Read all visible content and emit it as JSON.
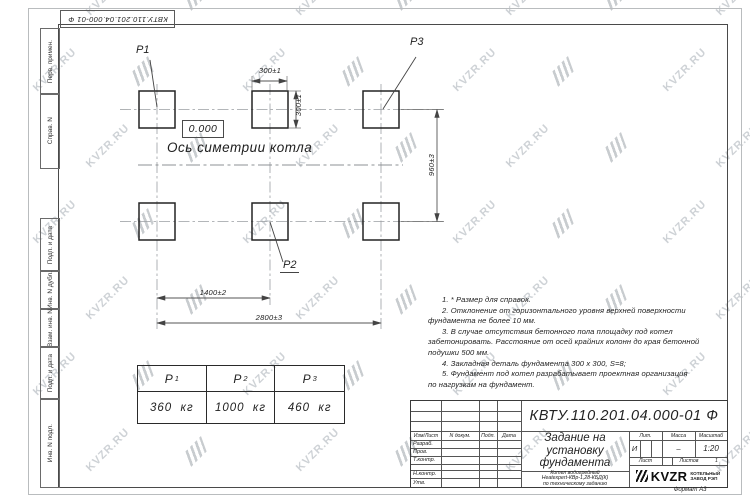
{
  "doc_number": "КВТУ.110.201.04.000-01 Ф",
  "watermark": {
    "text": "KVZR.RU"
  },
  "margin_labels": {
    "perv_primen": "Перв. примен.",
    "sprav_n": "Справ. N",
    "podp_data_1": "Подп. и дата",
    "inv_n_dubl": "Инв. N дубл.",
    "vzam_inv_n": "Взам. инв. N",
    "podp_data_2": "Подп. и дата",
    "inv_n_podl": "Инв. N подл."
  },
  "drawing": {
    "elevation": "0.000",
    "axis_label": "Ось симетрии котла",
    "labels": {
      "p1": "P1",
      "p2": "P2",
      "p3": "P3"
    },
    "dims": {
      "pad_width": "300±1",
      "pad_height": "300±1",
      "row_pitch": "960±3",
      "col_pitch": "1400±2",
      "overall": "2800±3"
    }
  },
  "load_table": {
    "columns": [
      {
        "name": "P",
        "sub": "1",
        "value": "360  кг"
      },
      {
        "name": "P",
        "sub": "2",
        "value": "1000  кг"
      },
      {
        "name": "P",
        "sub": "3",
        "value": "460  кг"
      }
    ]
  },
  "notes": [
    {
      "text": "1. * Размер для справок."
    },
    {
      "text": "2. Отклонение от горизонтального уровня верхней поверхности"
    },
    {
      "text": "фундамента не более 10 мм."
    },
    {
      "text": "3. В случае отсутствия бетонного пола площадку под котел"
    },
    {
      "text": "забетонировать. Расстояние от осей крайних колонн до края бетонной"
    },
    {
      "text": "подушки 500 мм."
    },
    {
      "text": "4. Закладная деталь фундамента  300 х 300, S=8;"
    },
    {
      "text": "5. Фундамент под котел разрабатывает проектная организация"
    },
    {
      "text": "по нагрузкам на фундамент."
    }
  ],
  "title_block": {
    "title_lines": [
      "Задание на",
      "установку",
      "фундамента"
    ],
    "product_lines": [
      "Котел водогрейный",
      "Heatexpert-КВр-1,28-КБД(К)",
      "по техническому заданию"
    ],
    "header_cols": {
      "izm_list": "Изм/Лист",
      "n_dokum": "N докум.",
      "podp": "Подп.",
      "data": "Дата"
    },
    "row_labels": {
      "razrab": "Разраб.",
      "prov": "Пров.",
      "tkontr": "Т.контр.",
      "nkontr": "Н.контр.",
      "utv": "Утв."
    },
    "lit_header": "Лит.",
    "massa_header": "Масса",
    "masshtab_header": "Масштаб",
    "lit_value": "И",
    "massa_value": "–",
    "masshtab_value": "1:20",
    "list_label": "Лист",
    "listov_label": "Листов",
    "listov_value": "1",
    "logo_text": "KVZR",
    "company_line1": "КОТЕЛЬНЫЙ",
    "company_line2": "ЗАВОД РЭП",
    "format_label": "Формат А3"
  }
}
